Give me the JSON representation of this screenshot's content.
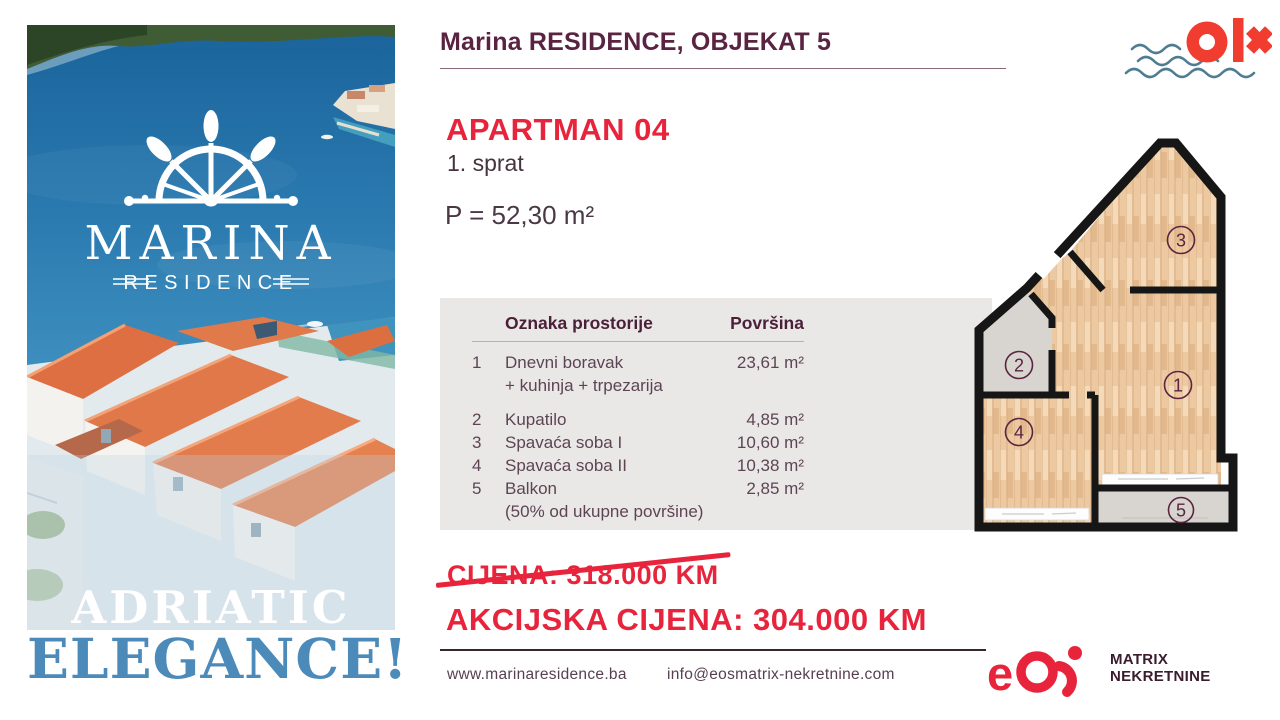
{
  "header": {
    "title": "Marina RESIDENCE, OBJEKAT 5"
  },
  "apartment": {
    "name": "APARTMAN 04",
    "floor": "1. sprat",
    "area": "P = 52,30 m²"
  },
  "table": {
    "col_label": "Oznaka prostorije",
    "col_area": "Površina",
    "rows": [
      {
        "num": "1",
        "name": "Dnevni boravak",
        "name2": "+ kuhinja + trpezarija",
        "area": "23,61 m²"
      },
      {
        "num": "2",
        "name": "Kupatilo",
        "area": "4,85 m²"
      },
      {
        "num": "3",
        "name": "Spavaća soba I",
        "area": "10,60 m²"
      },
      {
        "num": "4",
        "name": "Spavaća soba II",
        "area": "10,38 m²"
      },
      {
        "num": "5",
        "name": "Balkon",
        "name2": "(50% od ukupne površine)",
        "area": "2,85 m²"
      }
    ]
  },
  "floorplan": {
    "rooms": [
      "1",
      "2",
      "3",
      "4",
      "5"
    ]
  },
  "pricing": {
    "old": "CIJENA: 318.000 KM",
    "new": "AKCIJSKA CIJENA: 304.000 KM"
  },
  "footer": {
    "website": "www.marinaresidence.ba",
    "email": "info@eosmatrix-nekretnine.com"
  },
  "left_panel": {
    "brand_top": "MARINA",
    "brand_bottom": "RESIDENCE",
    "tagline1": "ADRIATIC",
    "tagline2": "ELEGANCE!"
  },
  "logos": {
    "eos_e": "e",
    "agency1": "MATRIX",
    "agency2": "NEKRETNINE"
  },
  "colors": {
    "red": "#e8243c",
    "plum": "#4a1f38",
    "text": "#5d4454",
    "blue": "#4c8bb9"
  }
}
